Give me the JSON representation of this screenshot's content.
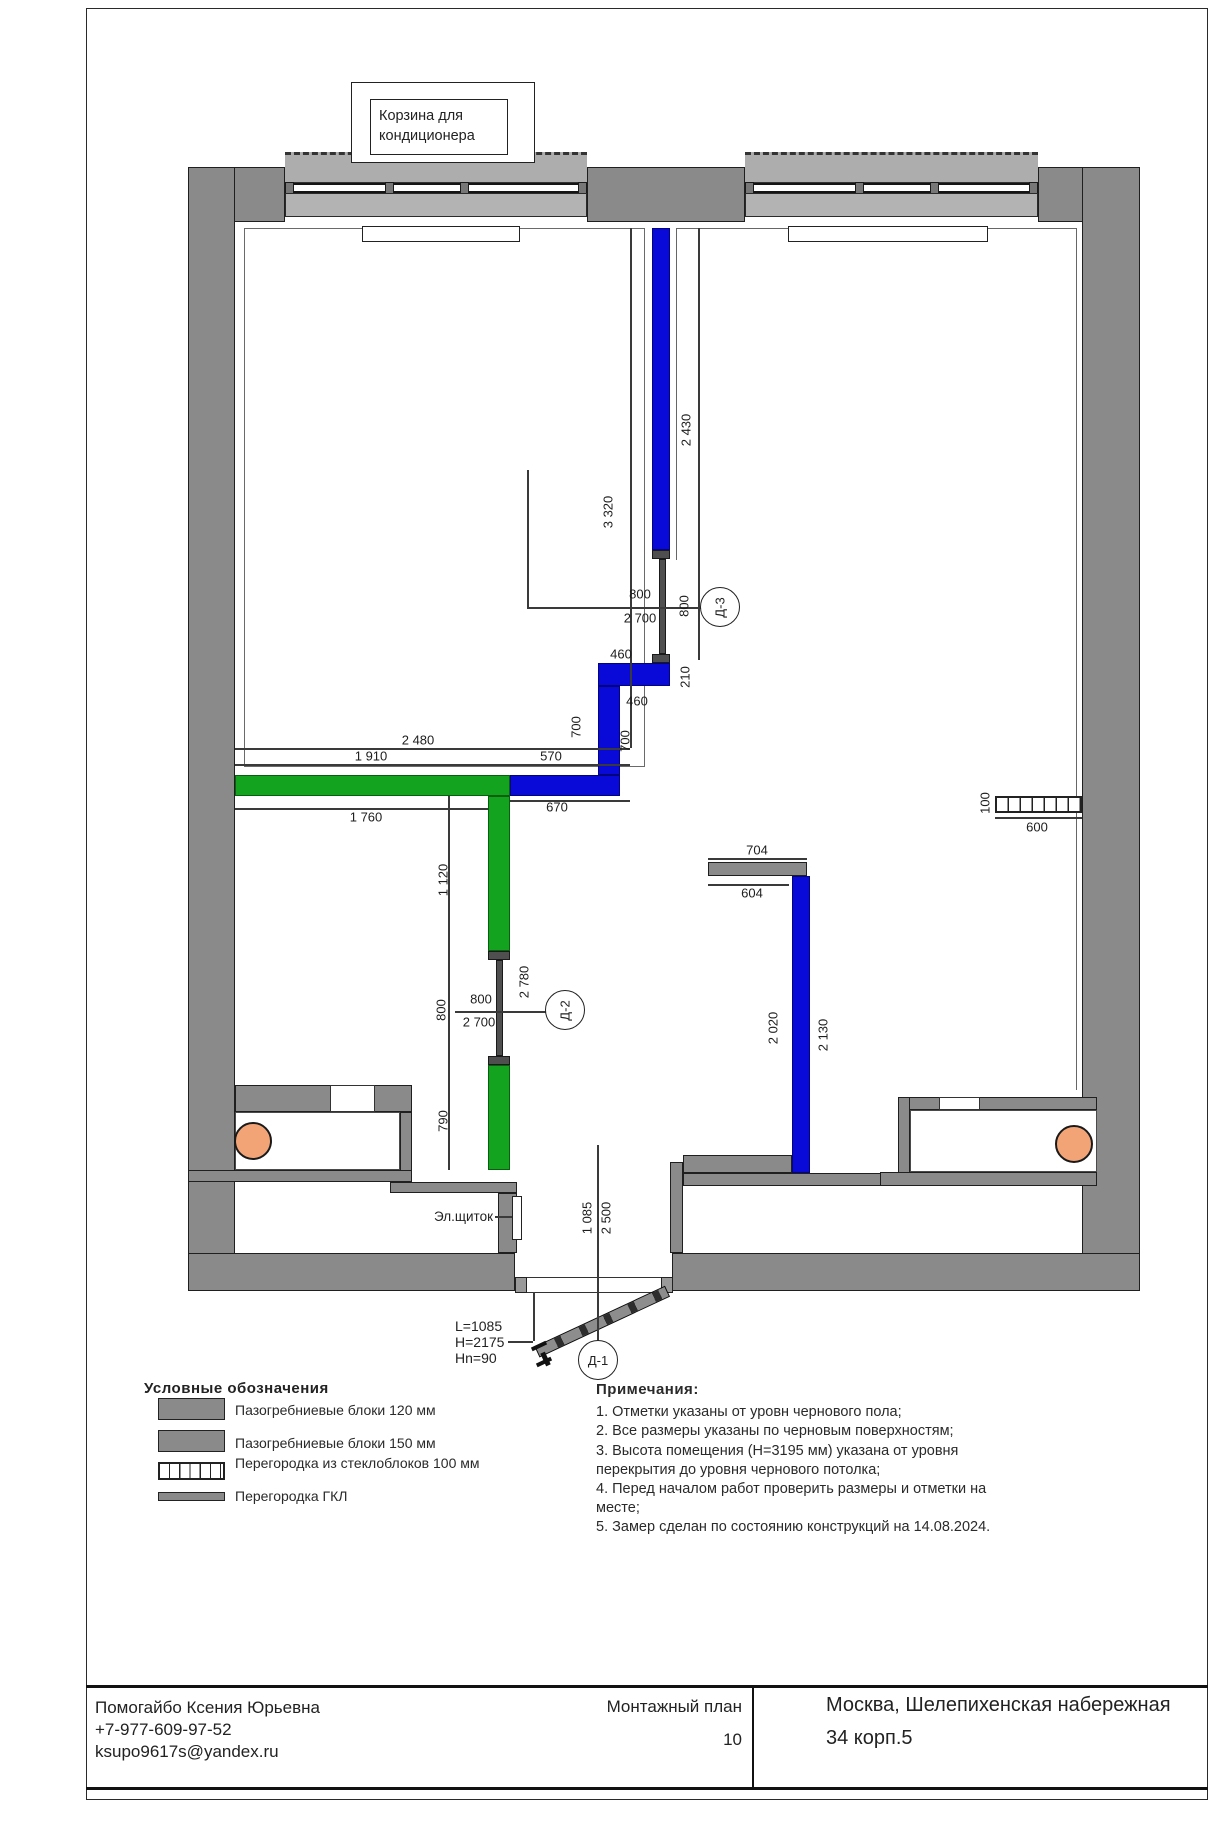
{
  "callout": {
    "text": "Корзина для кондиционера"
  },
  "dims": {
    "v3320": "3 320",
    "v2430": "2 430",
    "d3_w": "800",
    "d3_h": "2 700",
    "d3_wv": "800",
    "s460a": "460",
    "s210": "210",
    "s460b": "460",
    "s700a": "700",
    "s700b": "700",
    "s570": "570",
    "s670": "670",
    "h2480": "2 480",
    "h1910": "1 910",
    "h1760": "1 760",
    "v1120": "1 120",
    "d2_wv": "800",
    "d2_w": "800",
    "d2_h": "2 700",
    "v2780": "2 780",
    "v790": "790",
    "s704": "704",
    "s604": "604",
    "v2020": "2 020",
    "v2130": "2 130",
    "g100": "100",
    "g600": "600",
    "e1085": "1 085",
    "e2500": "2 500"
  },
  "doors": {
    "d1": "Д-1",
    "d2": "Д-2",
    "d3": "Д-3",
    "d1_spec1": "L=1085",
    "d1_spec2": "H=2175",
    "d1_spec3": "Hn=90"
  },
  "plan_labels": {
    "el_panel": "Эл.щиток"
  },
  "legend": {
    "title": "Условные обозначения",
    "items": [
      {
        "label": "Пазогребниевые блоки 120 мм"
      },
      {
        "label": "Пазогребниевые блоки 150 мм"
      },
      {
        "label": "Перегородка из стеклоблоков 100 мм"
      },
      {
        "label": "Перегородка ГКЛ"
      }
    ]
  },
  "notes": {
    "title": "Примечания:",
    "items": [
      "1. Отметки указаны от уровн чернового пола;",
      "2. Все размеры указаны по черновым поверхностям;",
      "3. Высота помещения (H=3195 мм) указана от уровня перекрытия до уровня чернового потолка;",
      "4. Перед началом работ проверить размеры и отметки на месте;",
      "5. Замер сделан по состоянию конструкций на 14.08.2024."
    ]
  },
  "titleblock": {
    "contact1": "Помогайбо Ксения Юрьевна",
    "contact2": "+7-977-609-97-52",
    "contact3": "ksupo9617s@yandex.ru",
    "doc_title": "Монтажный план",
    "page": "10",
    "address_line1": "Москва, Шелепихенская набережная",
    "address_line2": "34 корп.5"
  },
  "colors": {
    "wall_gray": "#8a8a8a",
    "window_gray": "#b3b3b3",
    "partition_blue": "#0909d8",
    "partition_green": "#13a31e",
    "column_orange": "#f2a477",
    "cap_gray": "#4f4f4f"
  }
}
